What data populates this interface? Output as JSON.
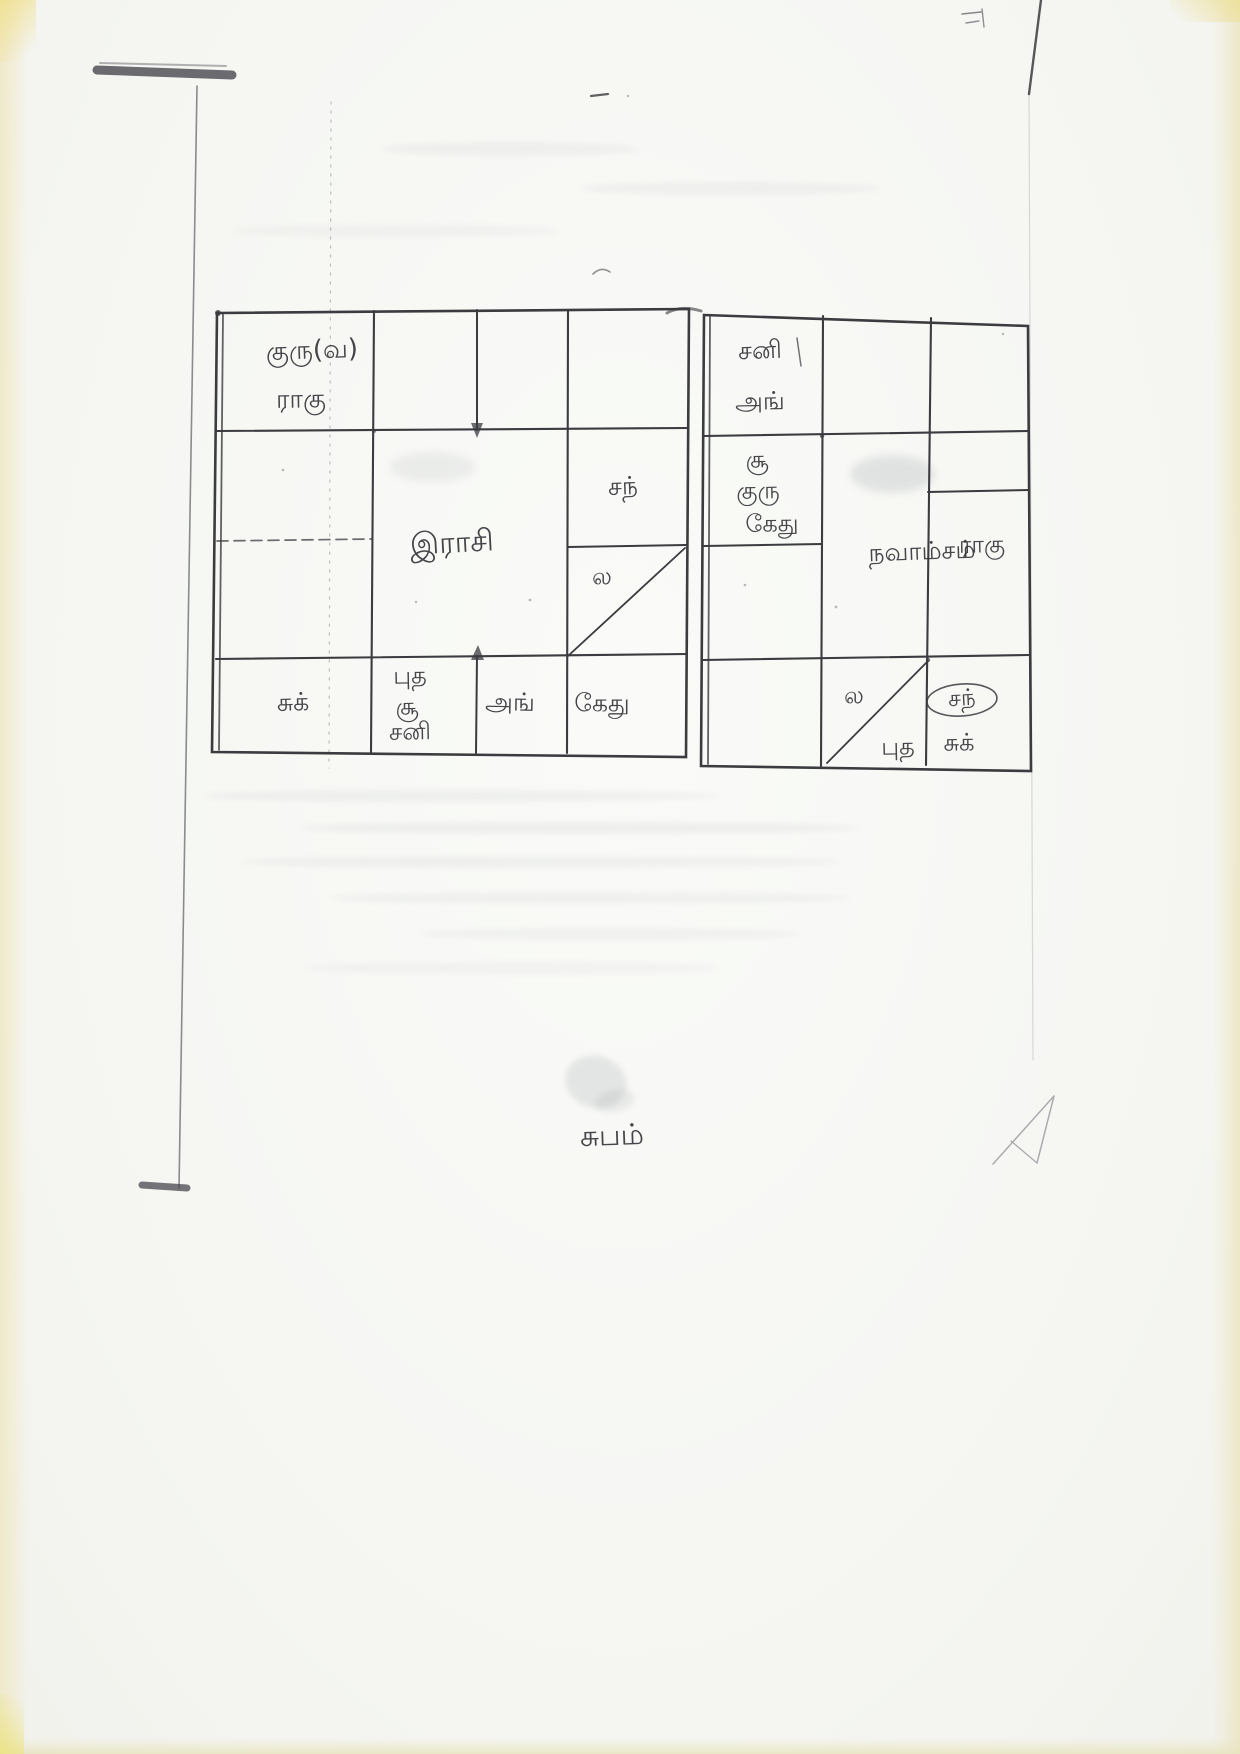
{
  "page": {
    "closing_text": "சுபம்"
  },
  "rasi_chart": {
    "label": "இராசி",
    "houses": {
      "jupiter": "குரு(வ)",
      "rahu": "ராகு",
      "moon": "சந்",
      "lagna": "ல",
      "venus": "சுக்",
      "mercury": "புத",
      "sun": "சூ",
      "saturn": "சனி",
      "mars": "அங்",
      "ketu": "கேது"
    }
  },
  "navamsam_chart": {
    "label": "நவாம்சம்",
    "houses": {
      "saturn": "சனி",
      "mars": "அங்",
      "sun": "சூ",
      "jupiter": "குரு",
      "ketu": "கேது",
      "rahu": "ராகு",
      "lagna": "ல",
      "mercury": "புத",
      "moon": "சந்",
      "venus": "சுக்"
    }
  }
}
